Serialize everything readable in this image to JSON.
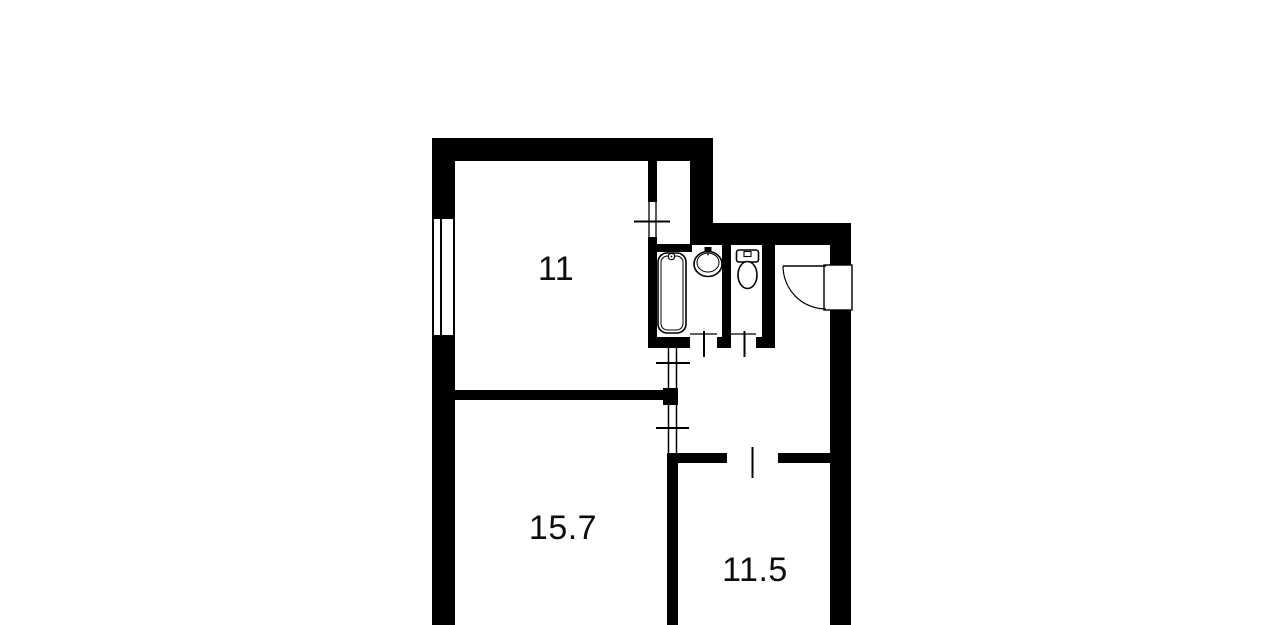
{
  "floor_plan": {
    "background_color": "#ffffff",
    "wall_color": "#000000",
    "rooms": [
      {
        "id": "room-top-left",
        "label": "11"
      },
      {
        "id": "room-bottom-left",
        "label": "15.7"
      },
      {
        "id": "room-bottom-right",
        "label": "11.5"
      }
    ],
    "fixtures": [
      {
        "name": "bathtub"
      },
      {
        "name": "sink"
      },
      {
        "name": "toilet"
      },
      {
        "name": "entrance-door"
      },
      {
        "name": "window"
      }
    ]
  }
}
